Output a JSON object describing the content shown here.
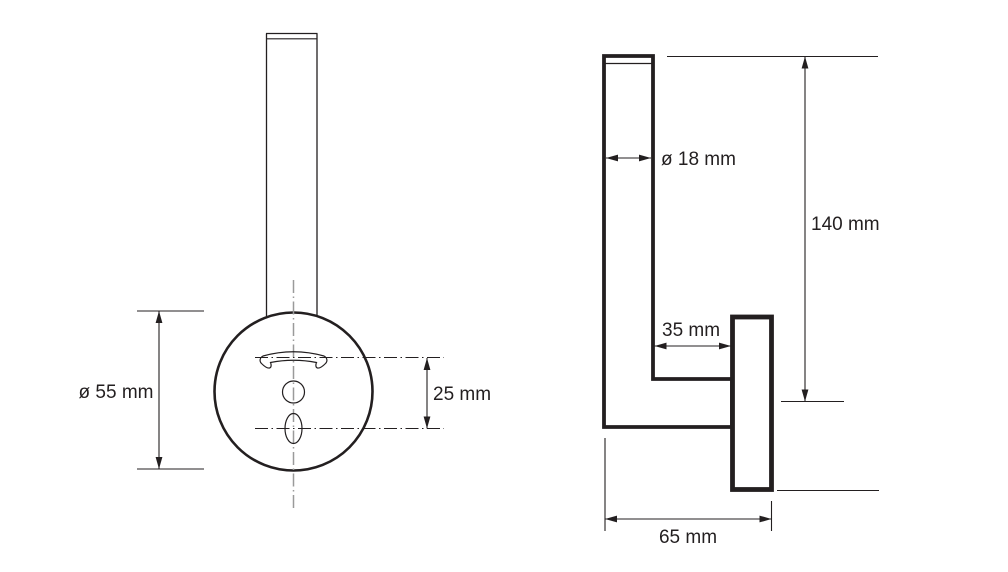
{
  "page": {
    "colors": {
      "paper": "#ffffff",
      "ink": "#231f20",
      "centerline": "#9a9a9a"
    }
  },
  "front_view": {
    "labels": {
      "plate_diameter": "ø 55 mm",
      "hole_offset": "25 mm"
    }
  },
  "side_view": {
    "labels": {
      "rod_diameter": "ø 18 mm",
      "total_height": "140 mm",
      "wall_offset": "35 mm",
      "total_depth": "65 mm"
    }
  }
}
